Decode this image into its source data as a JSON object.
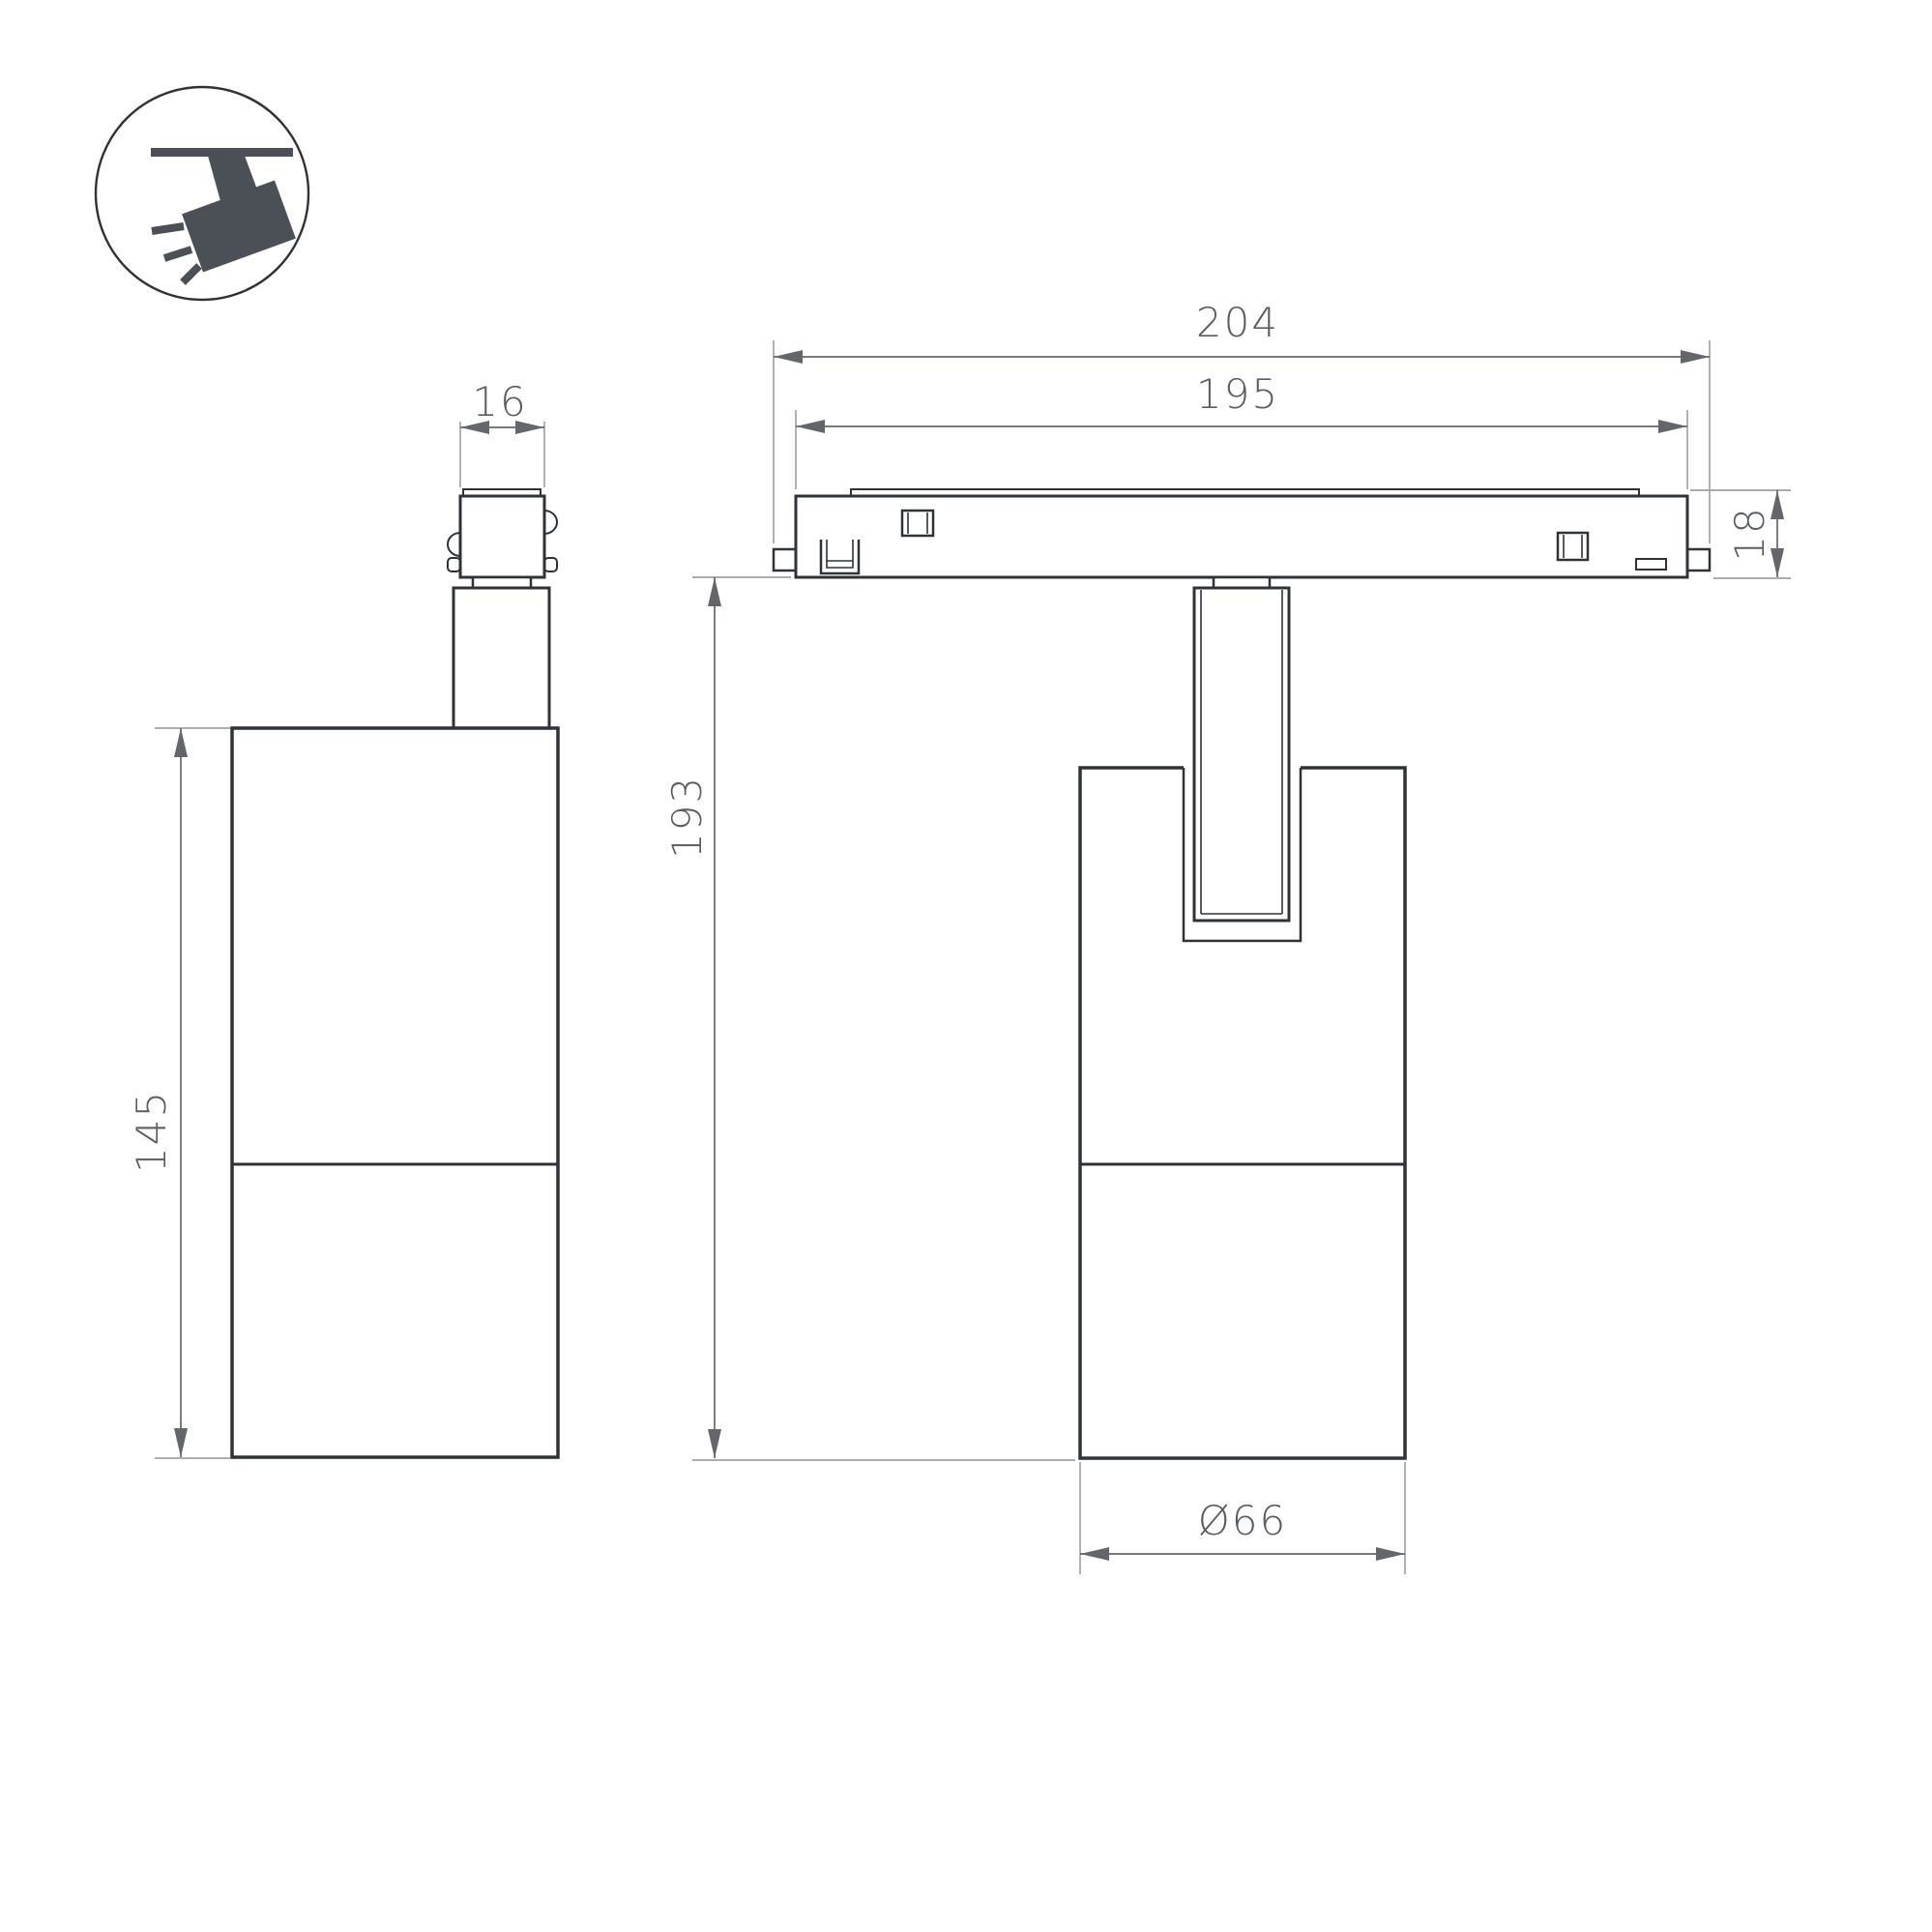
{
  "page": {
    "background": "#ffffff"
  },
  "colors": {
    "outline": "#2f3337",
    "dimension": "#63676b",
    "extension": "#8f9497",
    "text": "#5a5e62",
    "icon": "#4a5056"
  },
  "icon": {
    "meaning": "ceiling-track-spotlight"
  },
  "views": {
    "side": {
      "label": "side view of track spotlight",
      "dims": {
        "adapter_width": "16",
        "body_height": "145"
      }
    },
    "front": {
      "label": "front view of track spotlight on track",
      "dims": {
        "track_overall_length": "204",
        "track_body_length": "195",
        "track_height": "18",
        "overall_height": "193",
        "body_diameter": "Ø66"
      }
    }
  }
}
